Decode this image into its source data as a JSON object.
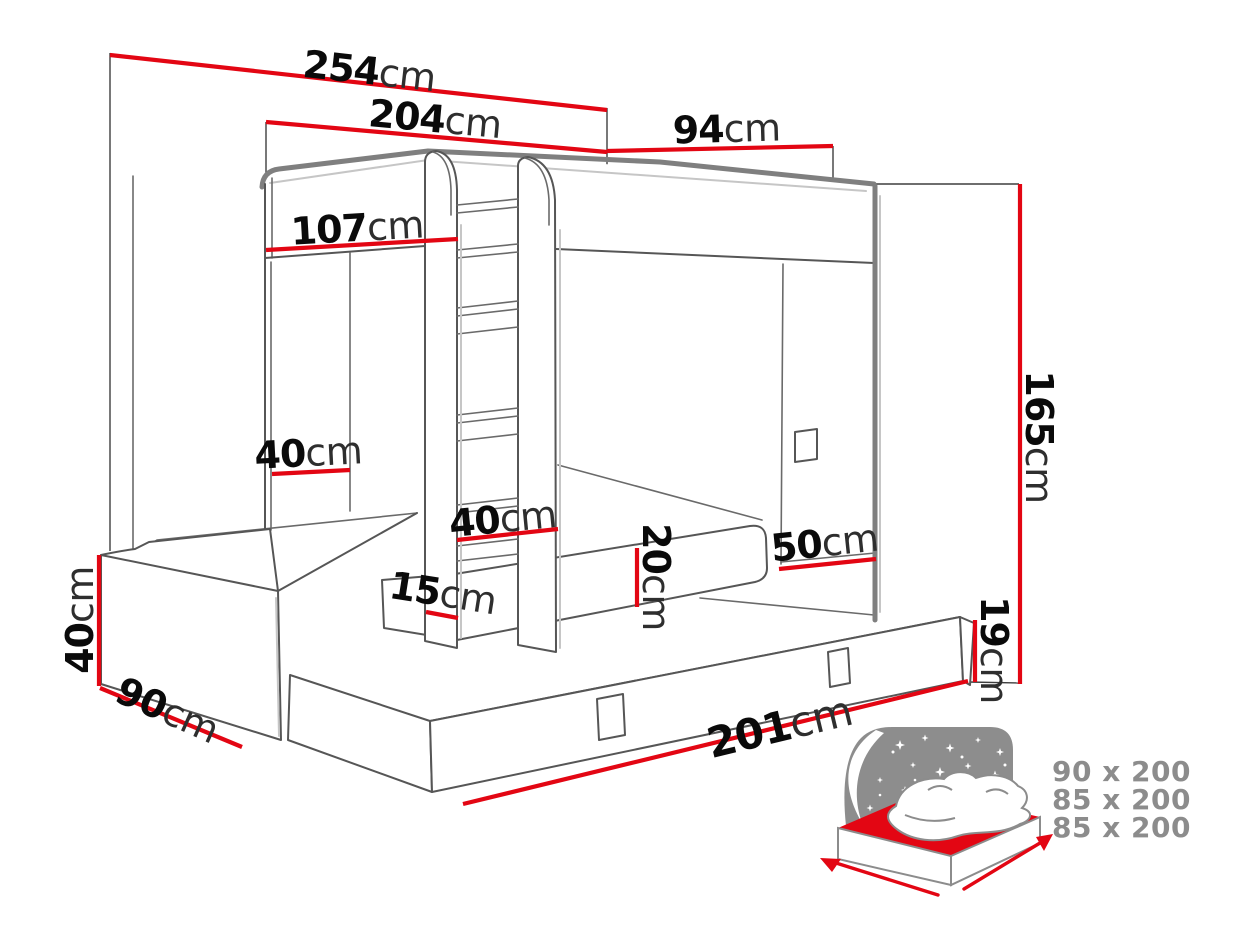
{
  "title": "Bunk bed with pull-out bed - dimensions diagram",
  "colors": {
    "dimension_red": "#e30613",
    "outline_gray": "#7f7f7f",
    "label_number_black": "#0a0a0a",
    "label_unit_gray": "#2e2e2e",
    "mattress_size_text_gray": "#8c8c8c",
    "background": "#ffffff"
  },
  "dimensions": {
    "total_width": {
      "value": "254",
      "unit": "cm"
    },
    "upper_bed_length": {
      "value": "204",
      "unit": "cm"
    },
    "side_depth": {
      "value": "94",
      "unit": "cm"
    },
    "left_opening_width": {
      "value": "107",
      "unit": "cm"
    },
    "headboard_wall": {
      "value": "40",
      "unit": "cm"
    },
    "ladder_width": {
      "value": "40",
      "unit": "cm"
    },
    "ladder_depth": {
      "value": "15",
      "unit": "cm"
    },
    "mattress_thickness": {
      "value": "20",
      "unit": "cm"
    },
    "base_height": {
      "value": "50",
      "unit": "cm"
    },
    "total_height": {
      "value": "165",
      "unit": "cm"
    },
    "drawer_height": {
      "value": "19",
      "unit": "cm"
    },
    "bench_height": {
      "value": "40",
      "unit": "cm"
    },
    "bench_depth": {
      "value": "90",
      "unit": "cm"
    },
    "drawer_length": {
      "value": "201",
      "unit": "cm"
    }
  },
  "mattress_sizes": [
    "90 x 200",
    "85 x 200",
    "85 x 200"
  ]
}
